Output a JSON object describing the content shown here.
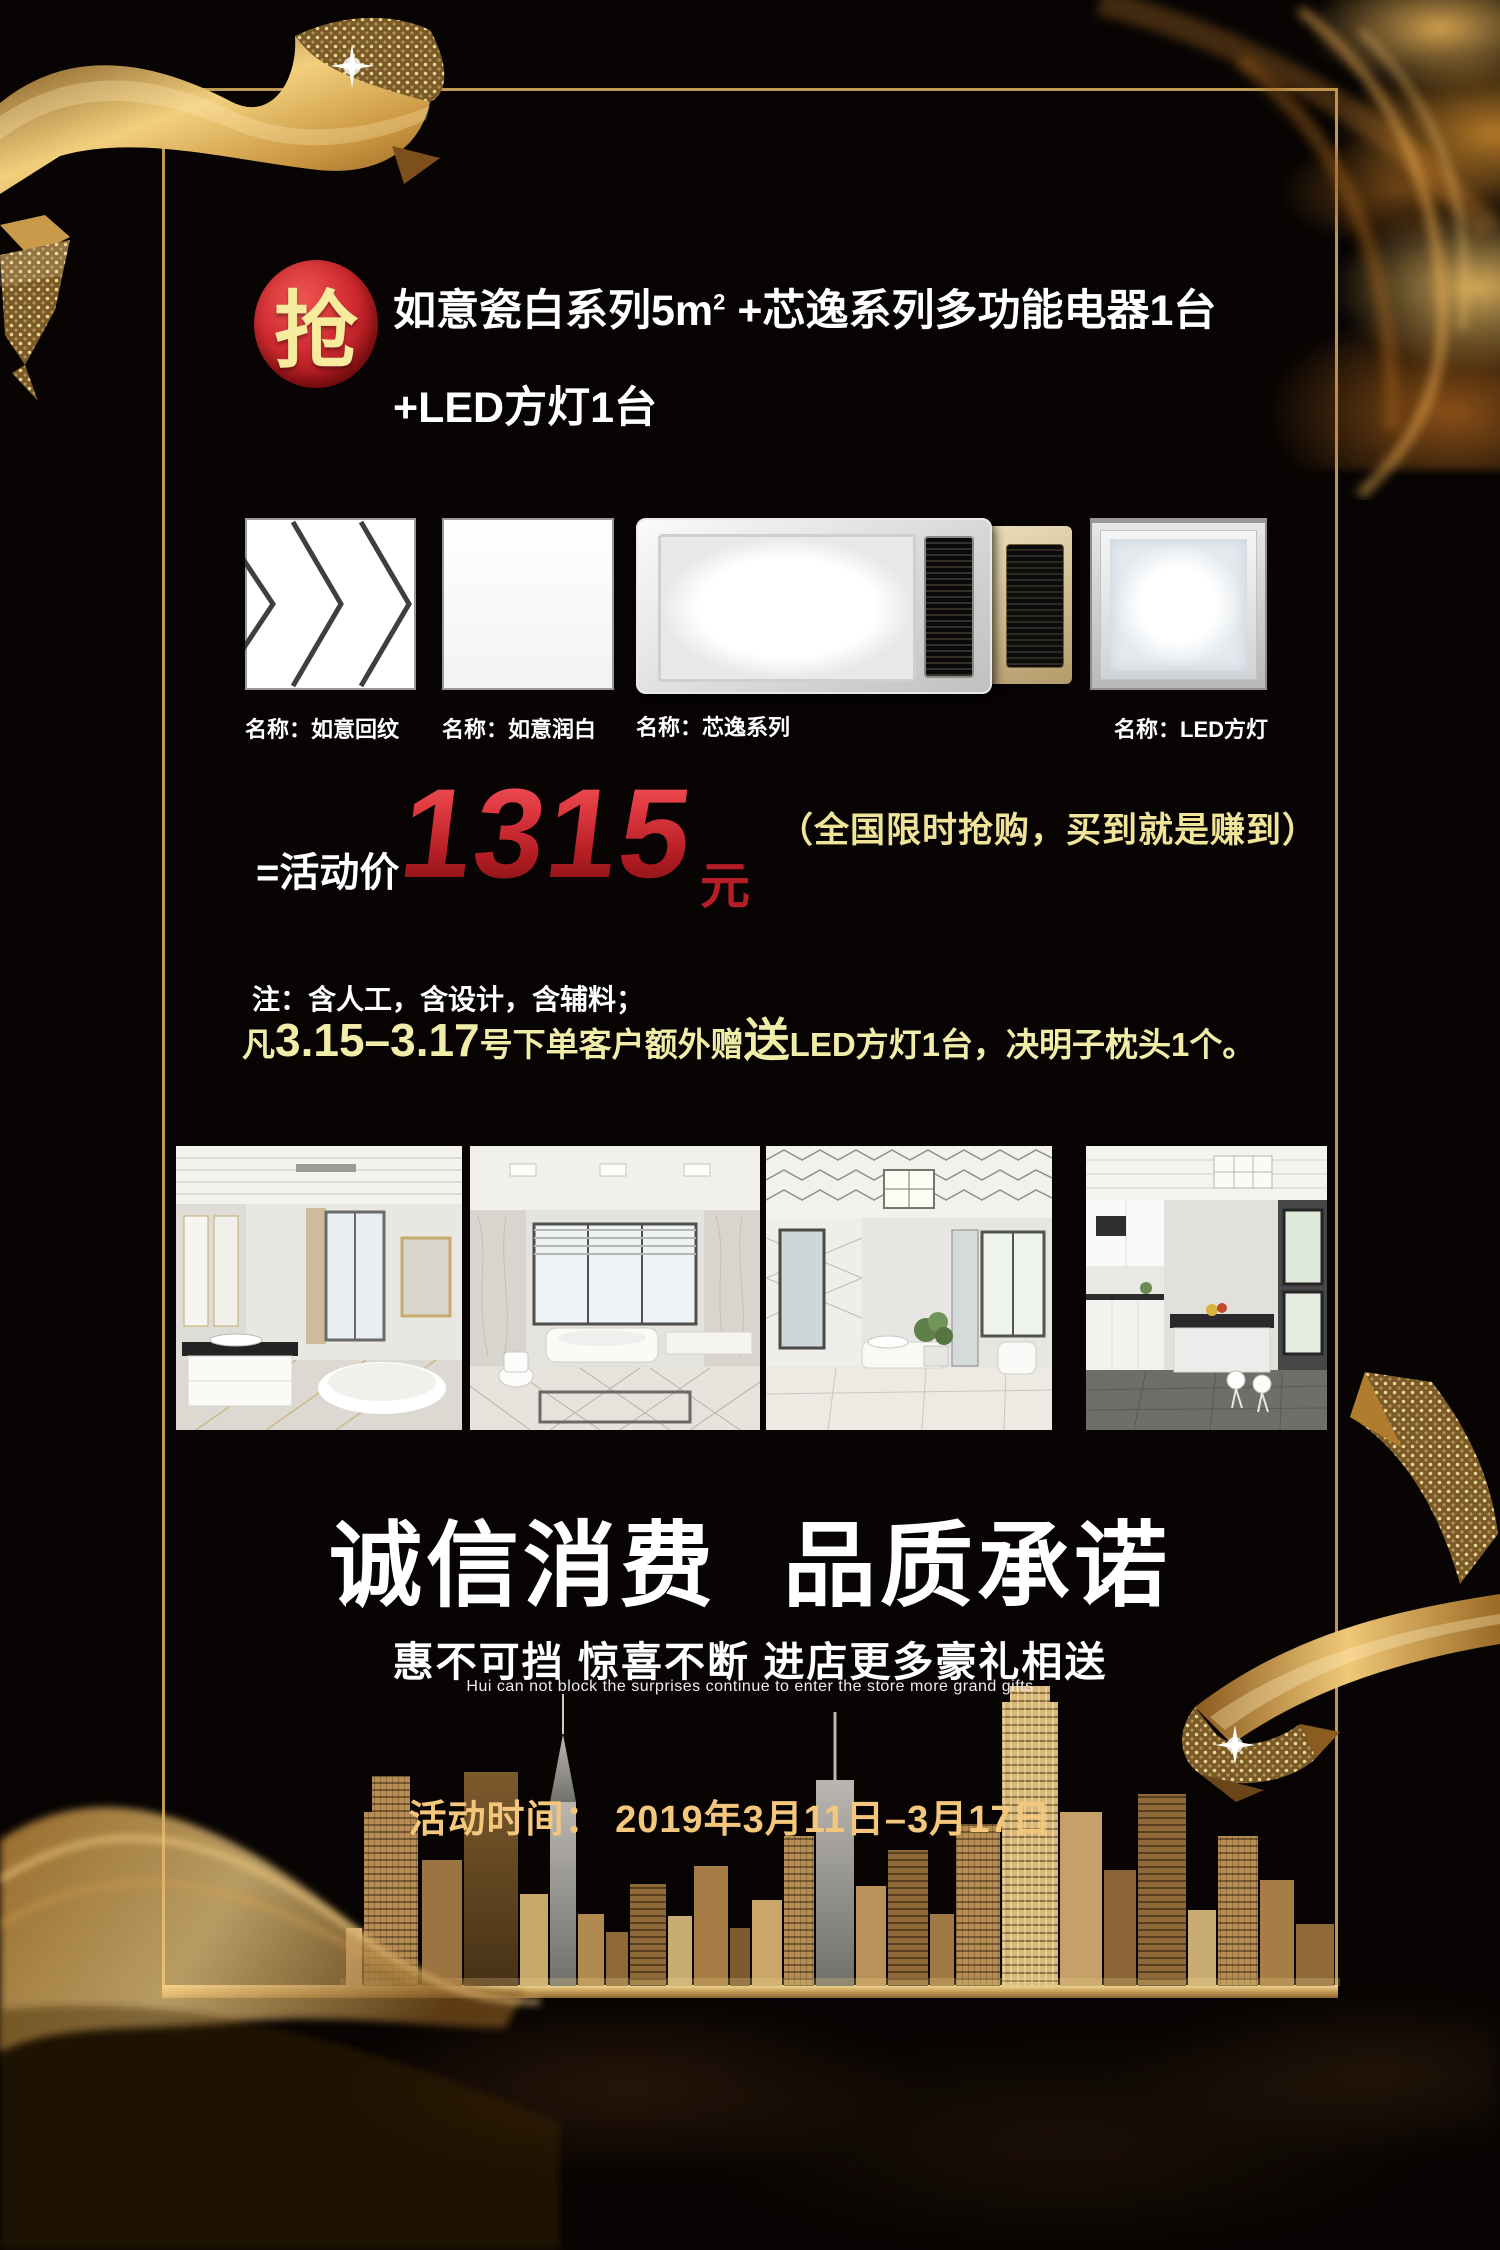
{
  "poster": {
    "badge_label": "抢",
    "headline": {
      "line1_pre": "如意瓷白系列5m",
      "line1_sup": "2",
      "line1_post": " +芯逸系列多功能电器1台",
      "line2": "+LED方灯1台"
    },
    "products": [
      {
        "label": "名称：如意回纹"
      },
      {
        "label": "名称：如意润白"
      },
      {
        "label": "名称：芯逸系列"
      },
      {
        "label": "名称：LED方灯"
      }
    ],
    "price": {
      "prefix": "=活动价",
      "amount": "1315",
      "unit": "元",
      "tagline": "（全国限时抢购，买到就是赚到）"
    },
    "note": {
      "line1": "注：含人工，含设计，含辅料；",
      "line2_head": "凡",
      "line2_dates": "3.15–3.17",
      "line2_mid": "号下单客户额外赠",
      "line2_emph": "送",
      "line2_tail": "LED方灯1台，决明子枕头1个。"
    },
    "slogan": {
      "part1": "诚信消费",
      "part2": "品质承诺"
    },
    "subtitle": "惠不可挡 惊喜不断 进店更多豪礼相送",
    "subtitle_en": "Hui can not block the surprises continue to enter the store more grand gifts",
    "event_time": "活动时间： 2019年3月11日–3月17日",
    "colors": {
      "background": "#070403",
      "frame_gold": "#bf9a55",
      "badge_red": "#c6242b",
      "badge_text": "#f7eb9e",
      "price_red": "#c2222a",
      "tagline_yellow": "#efe49a",
      "note_yellow": "#f1eda9",
      "date_gold": "#f4c77d",
      "text_white": "#ffffff"
    }
  }
}
